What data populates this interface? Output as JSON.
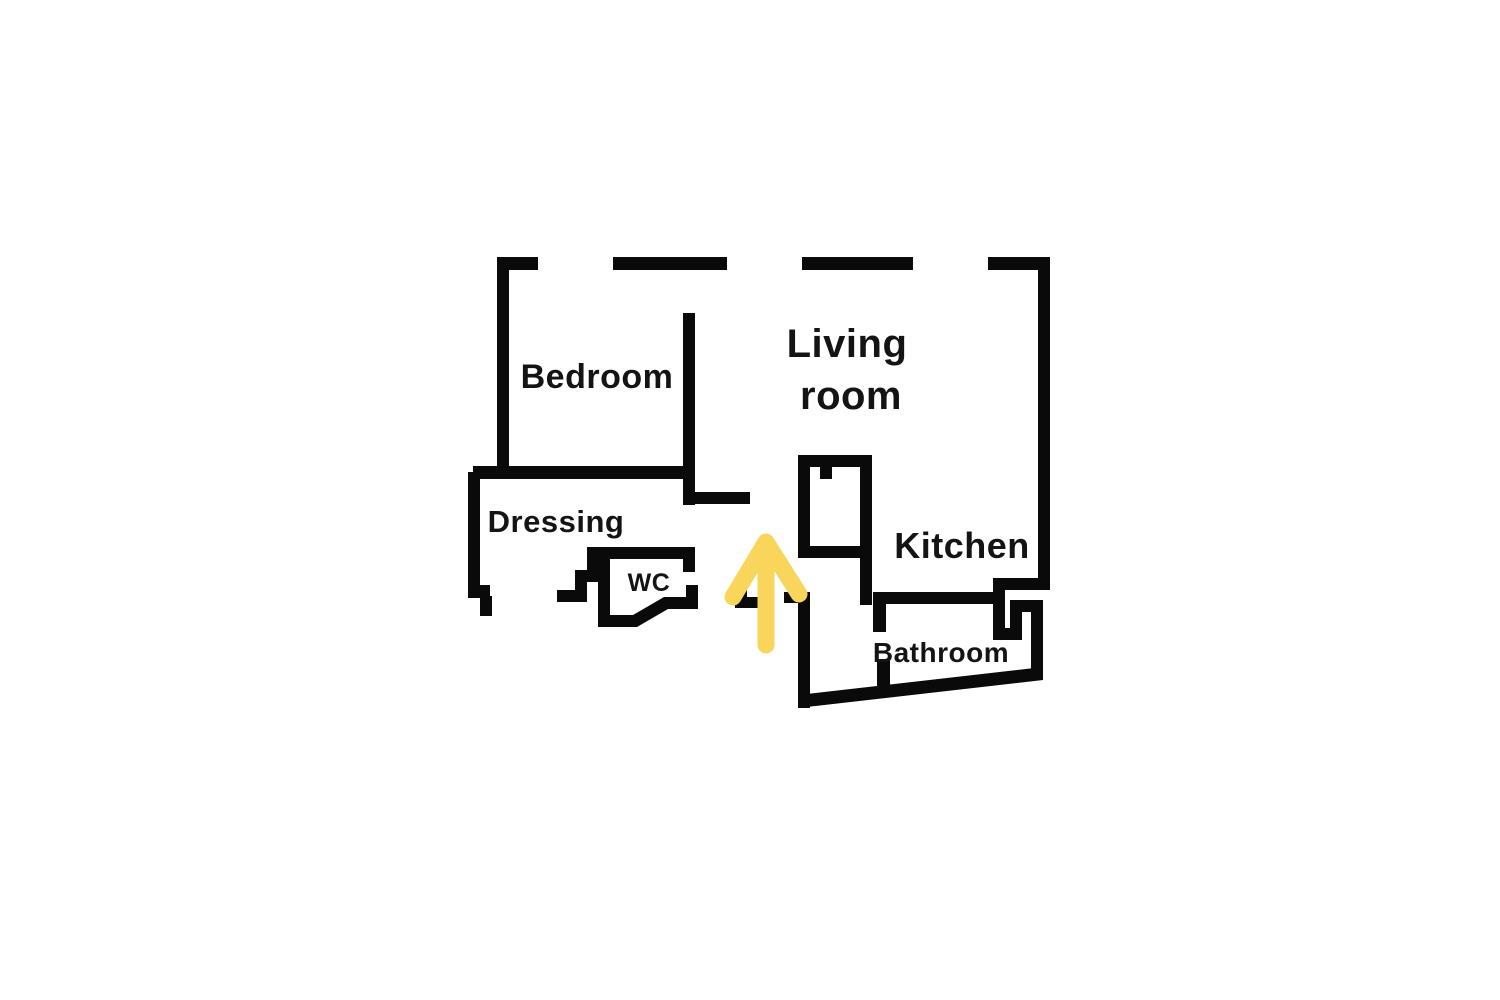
{
  "floor_plan": {
    "labels": {
      "bedroom": "Bedroom",
      "living_line1": "Living",
      "living_line2": "room",
      "dressing": "Dressing",
      "wc": "WC",
      "kitchen": "Kitchen",
      "bathroom": "Bathroom"
    },
    "colors": {
      "wall": "#0A0A0A",
      "text": "#141414",
      "arrow": "#F9D55C",
      "background": "#FFFFFF"
    },
    "entrance_arrow": {
      "direction": "up"
    }
  }
}
